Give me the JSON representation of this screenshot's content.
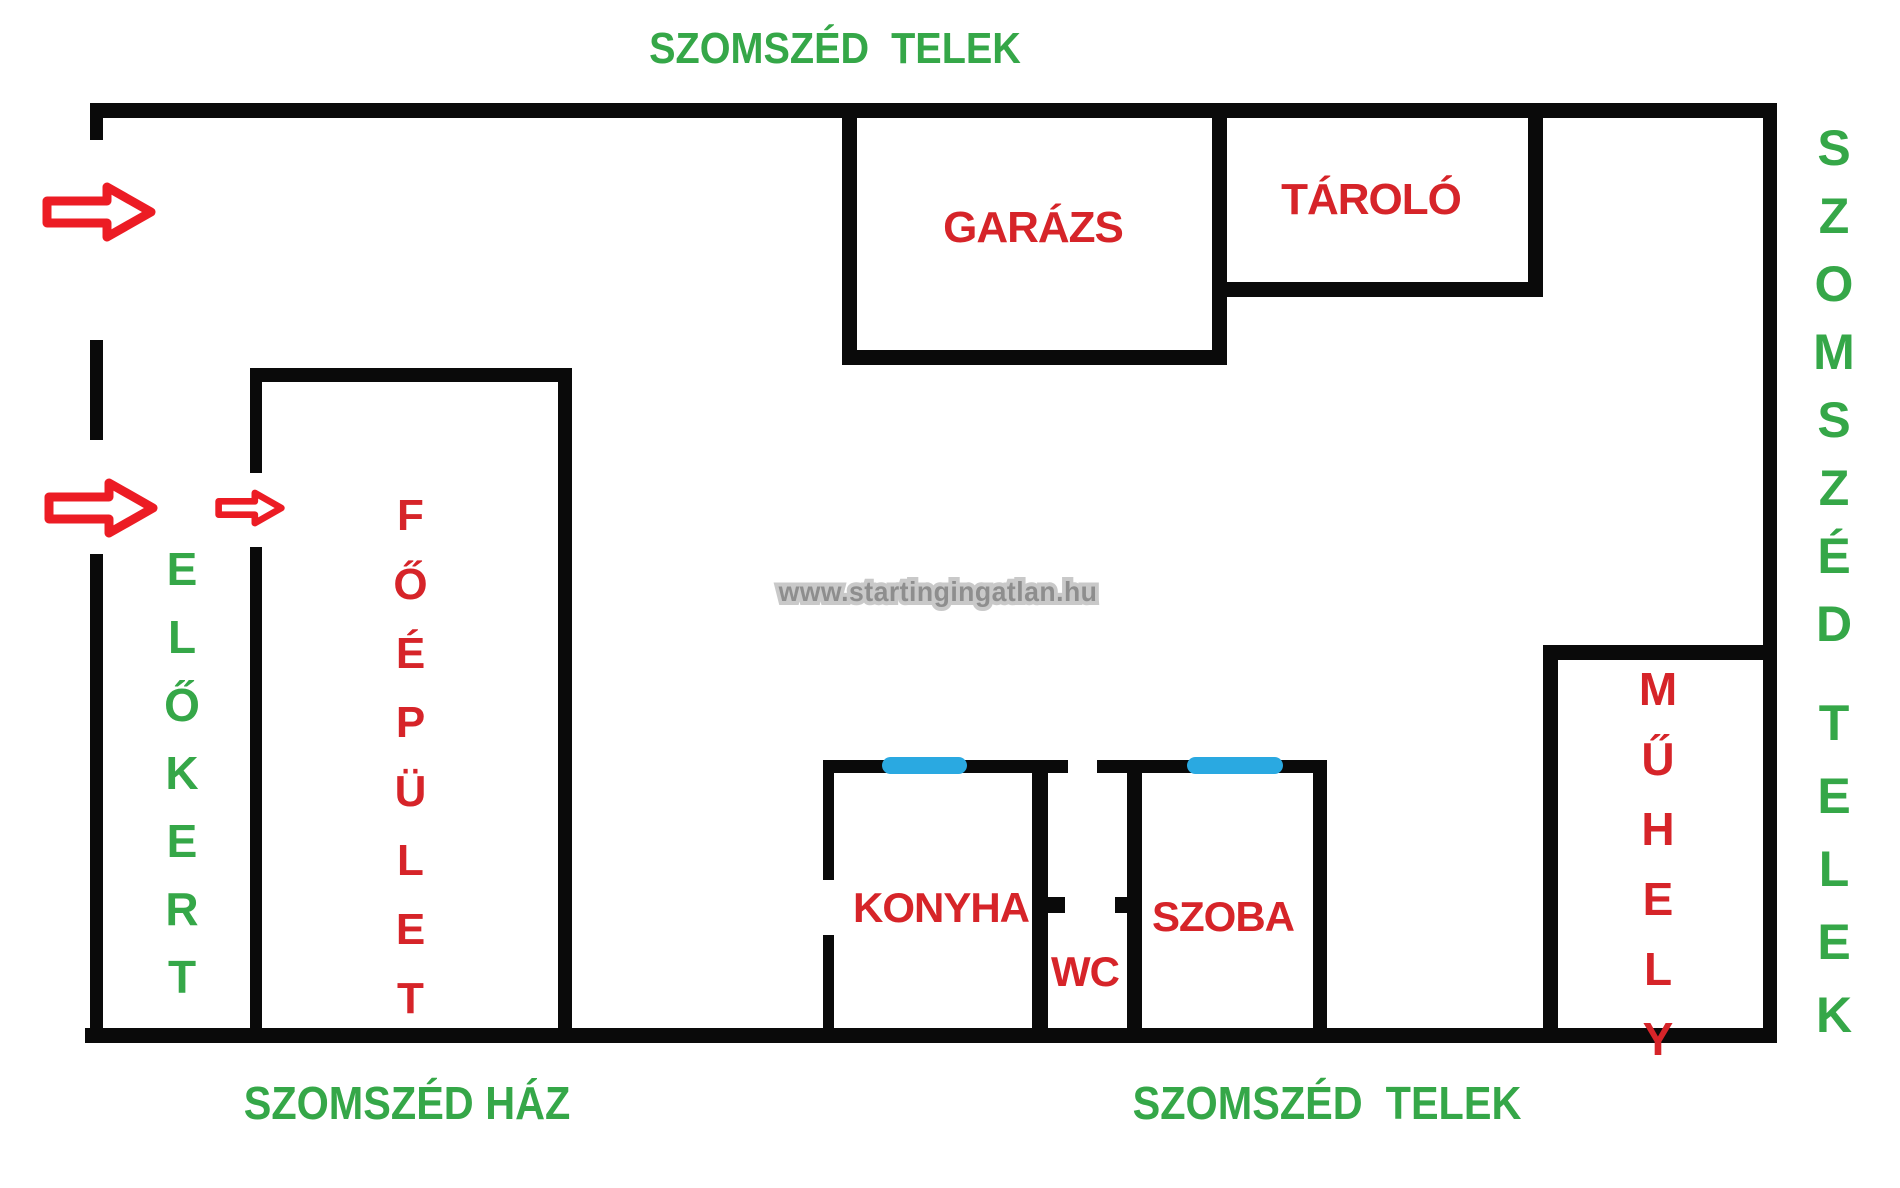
{
  "surroundings": {
    "top_neighbor": "SZOMSZÉD  TELEK",
    "right_neighbor_line1": "SZOMSZÉD",
    "right_neighbor_line2": "TELEK",
    "bottom_left_neighbor": "SZOMSZÉD HÁZ",
    "bottom_right_neighbor": "SZOMSZÉD  TELEK",
    "front_garden": "ELŐKERT"
  },
  "rooms": {
    "garage": "GARÁZS",
    "storage": "TÁROLÓ",
    "main_building": "FŐÉPÜLET",
    "workshop": "MŰHELY",
    "kitchen": "KONYHA",
    "wc": "WC",
    "living_room": "SZOBA"
  },
  "watermark": {
    "text": "www.startingingatlan.hu"
  },
  "icons": {
    "entrance_arrow": "right-arrow-icon",
    "window_marker": "window-icon"
  },
  "colors": {
    "wall_black": "#0a0a0a",
    "room_label_red": "#d62429",
    "neighbor_label_green": "#35a748",
    "window_blue": "#2aa9e1",
    "arrow_red": "#ec1c24",
    "watermark_gray": "#8e8e8e"
  }
}
